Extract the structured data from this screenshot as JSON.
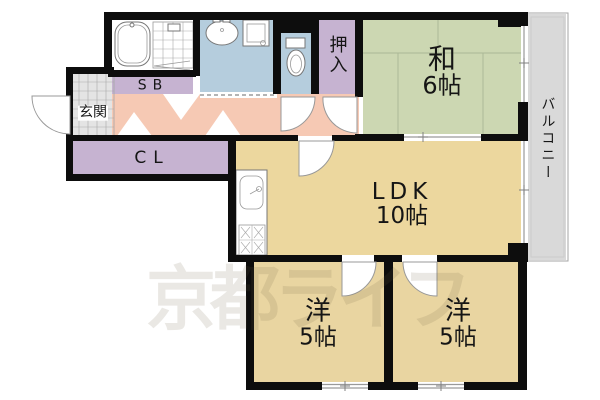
{
  "plan": {
    "title": "間取り図",
    "rooms": {
      "washitsu": {
        "label": "和",
        "size": "6帖"
      },
      "ldk": {
        "label": "LDK",
        "size": "10帖"
      },
      "western1": {
        "label": "洋",
        "size": "5帖"
      },
      "western2": {
        "label": "洋",
        "size": "5帖"
      },
      "oshiire": {
        "label": "押入"
      },
      "balcony": {
        "label": "バルコニー"
      },
      "genkan": {
        "label": "玄関"
      },
      "shoebox": {
        "label": "SB"
      },
      "closet": {
        "label": "CL"
      }
    },
    "watermark": "京都ライフ",
    "colors": {
      "wall": "#0d0d0d",
      "washitsu": "#ccd7b2",
      "ldk": "#ecd79e",
      "western": "#e9d5a1",
      "closet": "#c6b3d1",
      "hallway": "#f6c9b4",
      "wet": "#b5cddd",
      "balcony": "#d9d9d9",
      "tile": "#e4e4e4",
      "watermark": "rgba(105,95,65,0.14)"
    }
  }
}
